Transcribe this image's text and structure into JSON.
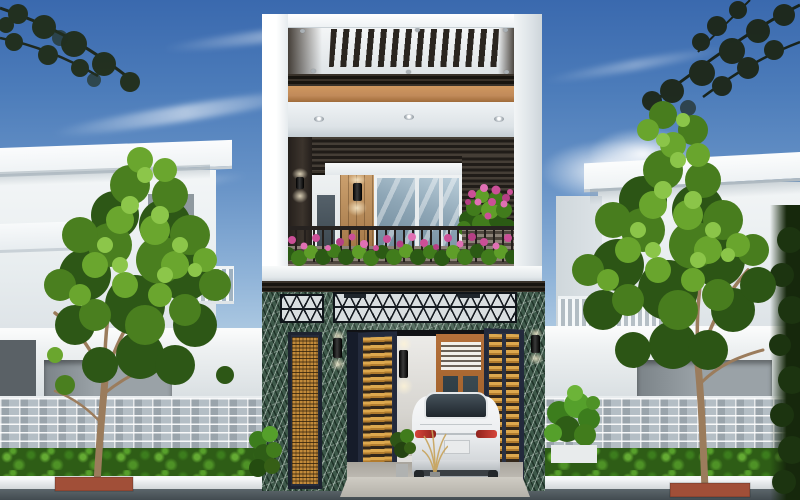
{
  "meta": {
    "type": "architectural-exterior-render",
    "subject": "modern three-storey townhouse street elevation with parked white sedan",
    "canvas": {
      "width": 800,
      "height": 500
    }
  },
  "palette": {
    "sky_top": "#3a69ae",
    "sky_horizon": "#e8f2f6",
    "cloud_white": "#ffffff",
    "foliage_dark": "#2c5515",
    "foliage_mid": "#487d1e",
    "foliage_light": "#8bc549",
    "trunk_brown": "#9b7c5c",
    "white_wall": "#f2f5f6",
    "copper_fascia": "#c18a5a",
    "slat_dark": "#2e2a24",
    "marble_green": "#3e594a",
    "gate_frame_navy": "#2a3143",
    "louver_orange": "#c28a3a",
    "glass_blue": "#8ea6b6",
    "car_white": "#eef0f2",
    "taillight_red": "#c03028",
    "stone_gray": "#b4bec5",
    "hedge_green": "#2e5d16",
    "curb_white": "#eef0f1",
    "road_asphalt": "#4d575c",
    "flower_pink": "#cb4f97",
    "planter_brick": "#a14f38"
  },
  "scene": {
    "sky": {
      "elements": [
        "cirrus-streaks",
        "cumulus-clouds",
        "overhanging-branch-silhouettes"
      ]
    },
    "main_house": {
      "storeys": 3,
      "roof_terrace": {
        "feature": "slatted-pergola-opening",
        "fascia": "copper-band",
        "ceiling_downlights": 3
      },
      "second_floor": {
        "window_panes": 3,
        "finishes": [
          "dark-wood-slat-wall",
          "tan-wood-panel",
          "white-plaster"
        ],
        "wall_lamps": 2,
        "balcony": {
          "railing": "dark-metal-balusters",
          "planting": "pink-flowers-with-green-foliage",
          "side_planter": "wood-slat-box"
        }
      },
      "ground_floor": {
        "cladding": "green-marble",
        "transom_grille": "diamond-lattice-metal",
        "gates": {
          "style": "folding-louver",
          "infill": "orange-wood",
          "frame": "navy-steel",
          "leaves_visible": 4
        },
        "wall_sconces": 3,
        "entry_door": "wood-frame-glass-with-louver-transom",
        "parked_car": {
          "type": "sedan",
          "color": "white",
          "view": "rear"
        },
        "plants": [
          "potted-plant",
          "ornamental-grass",
          "corner-shrub"
        ]
      }
    },
    "left_neighbor": {
      "type": "white-flat-roof-house",
      "fence": [
        "white-wall",
        "stone-brick-base",
        "hedge-row"
      ]
    },
    "right_neighbor": {
      "type": "white-flat-roof-house-with-balcony",
      "fence": [
        "white-wall",
        "stone-brick-base",
        "hedge-row"
      ]
    },
    "street": {
      "trees": 2,
      "tree_planters": "brick-red",
      "curb": "white",
      "road": "dark-asphalt"
    }
  }
}
